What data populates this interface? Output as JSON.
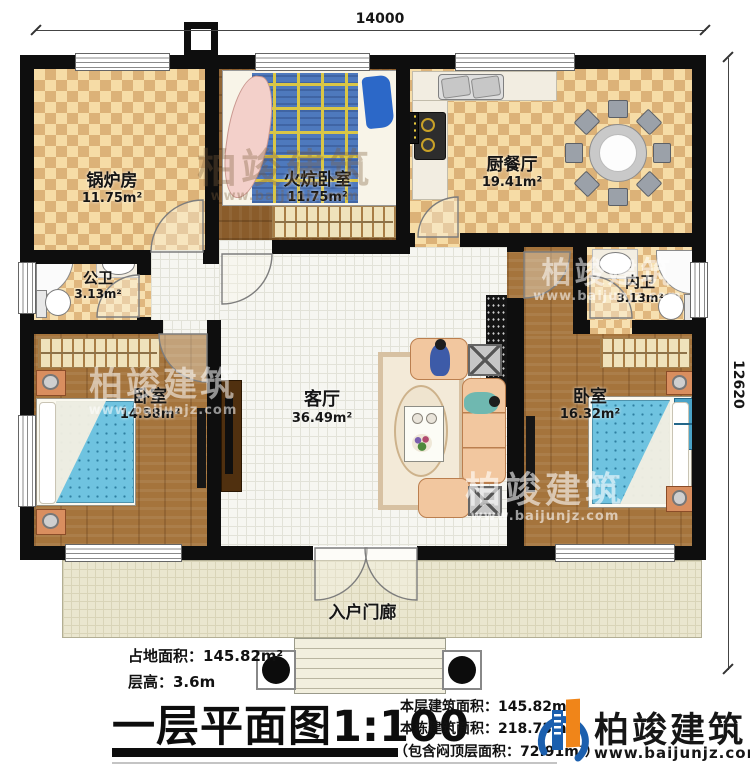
{
  "dimensions": {
    "top": "14000",
    "right": "12620"
  },
  "rooms": {
    "boiler": {
      "name": "锅炉房",
      "area": "11.75m²"
    },
    "kang_bedroom": {
      "name": "火炕卧室",
      "area": "11.75m²"
    },
    "kitchen": {
      "name": "厨餐厅",
      "area": "19.41m²"
    },
    "public_bath": {
      "name": "公卫",
      "area": "3.13m²"
    },
    "inner_bath": {
      "name": "内卫",
      "area": "3.13m²"
    },
    "bedroom_left": {
      "name": "卧室",
      "area": "14.58m²"
    },
    "bedroom_right": {
      "name": "卧室",
      "area": "16.32m²"
    },
    "living": {
      "name": "客厅",
      "area": "36.49m²"
    },
    "porch": {
      "name": "入户门廊"
    }
  },
  "info_left": {
    "line1": "占地面积：145.82m²",
    "line2": "层高：3.6m"
  },
  "title": {
    "text": "一层平面图",
    "scale": "1:100"
  },
  "info_right": {
    "line1": "本层建筑面积：145.82m²",
    "line2": "本栋建筑面积：218.73m²",
    "line3": "（包含闷顶层面积：72.91m²）"
  },
  "brand": {
    "name": "柏竣建筑",
    "url": "www.baijunjz.com"
  },
  "colors": {
    "brand_blue": "#1b5fae",
    "brand_orange": "#f08519",
    "wall": "#0e0e0e"
  }
}
